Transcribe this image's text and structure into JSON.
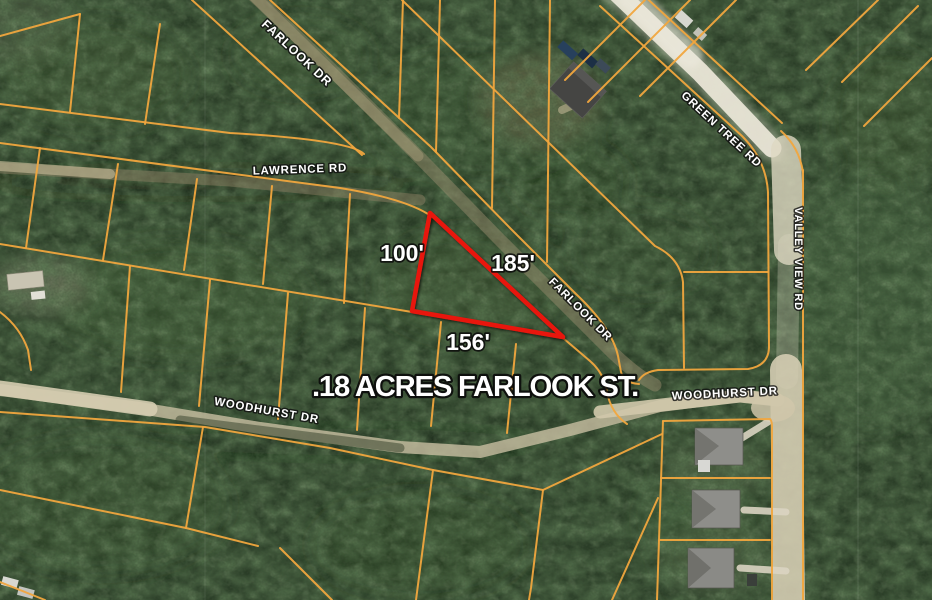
{
  "map": {
    "listing_label": ".18 ACRES FARLOOK ST.",
    "parcel": {
      "side_lengths": [
        "100'",
        "185'",
        "156'"
      ]
    },
    "street_labels": [
      {
        "name": "FARLOOK DR"
      },
      {
        "name": "LAWRENCE RD"
      },
      {
        "name": "GREEN TREE RD"
      },
      {
        "name": "VALLEY VIEW RD"
      },
      {
        "name": "FARLOOK DR"
      },
      {
        "name": "WOODHURST DR"
      },
      {
        "name": "WOODHURST DR"
      }
    ],
    "colors": {
      "parcel_lines": "#f1a73e",
      "parcel_highlight": "#e8190e",
      "label_text": "#ffffff",
      "forest_base": "#2a3d27",
      "dirt_road": "#d6cfb8"
    }
  }
}
